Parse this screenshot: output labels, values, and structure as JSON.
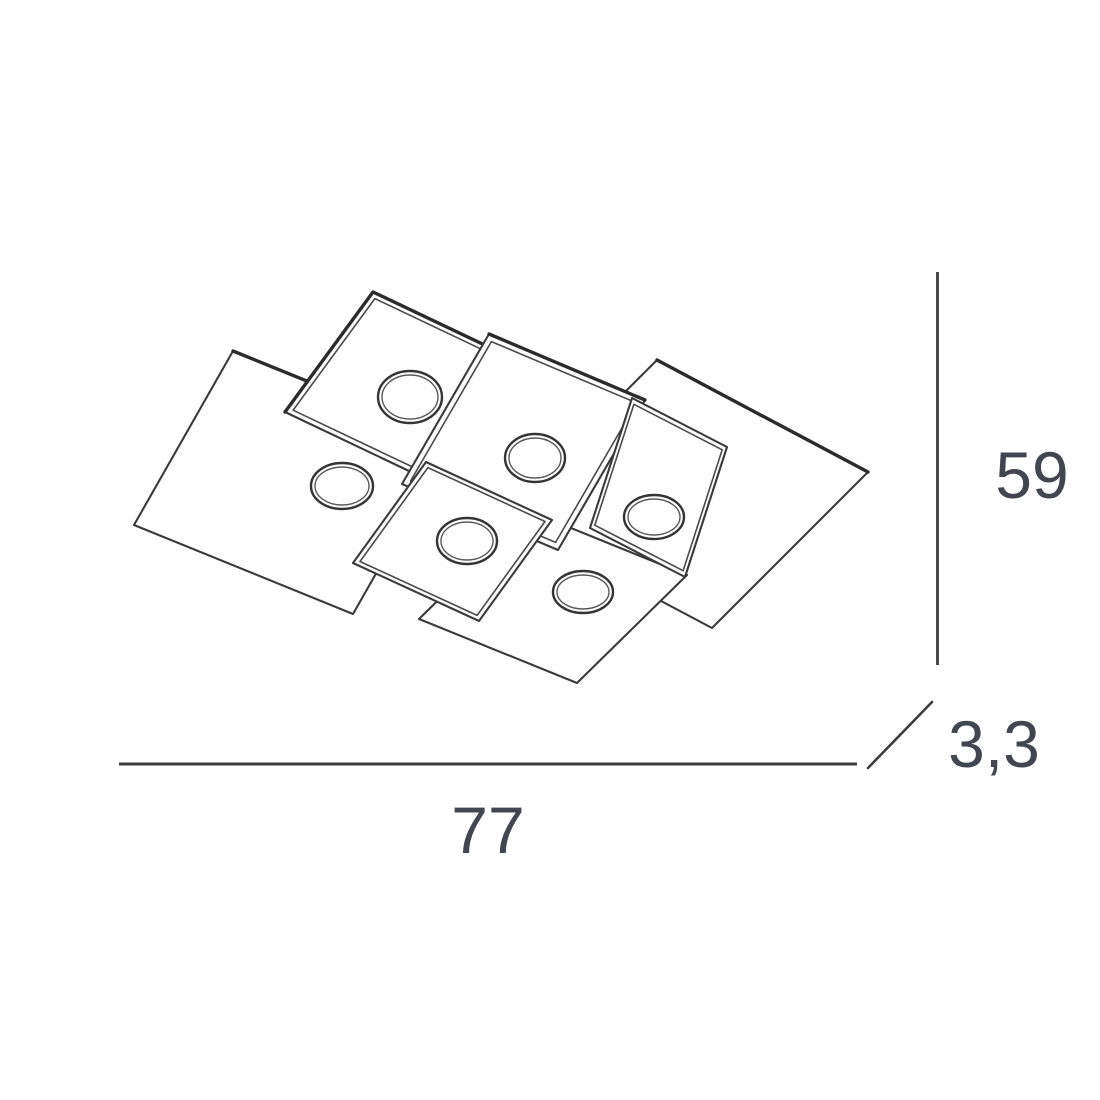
{
  "diagram": {
    "kind": "product dimension line drawing",
    "subject": "ceiling lamp made of overlapping square plates, isometric view from below",
    "lights_count": 6,
    "dimensions": {
      "width": "77",
      "height": "59",
      "thickness": "3,3"
    },
    "colors": {
      "background": "#ffffff",
      "line": "#3a3a3a",
      "heavy_line": "#2b2b2b",
      "text": "#414650"
    }
  }
}
